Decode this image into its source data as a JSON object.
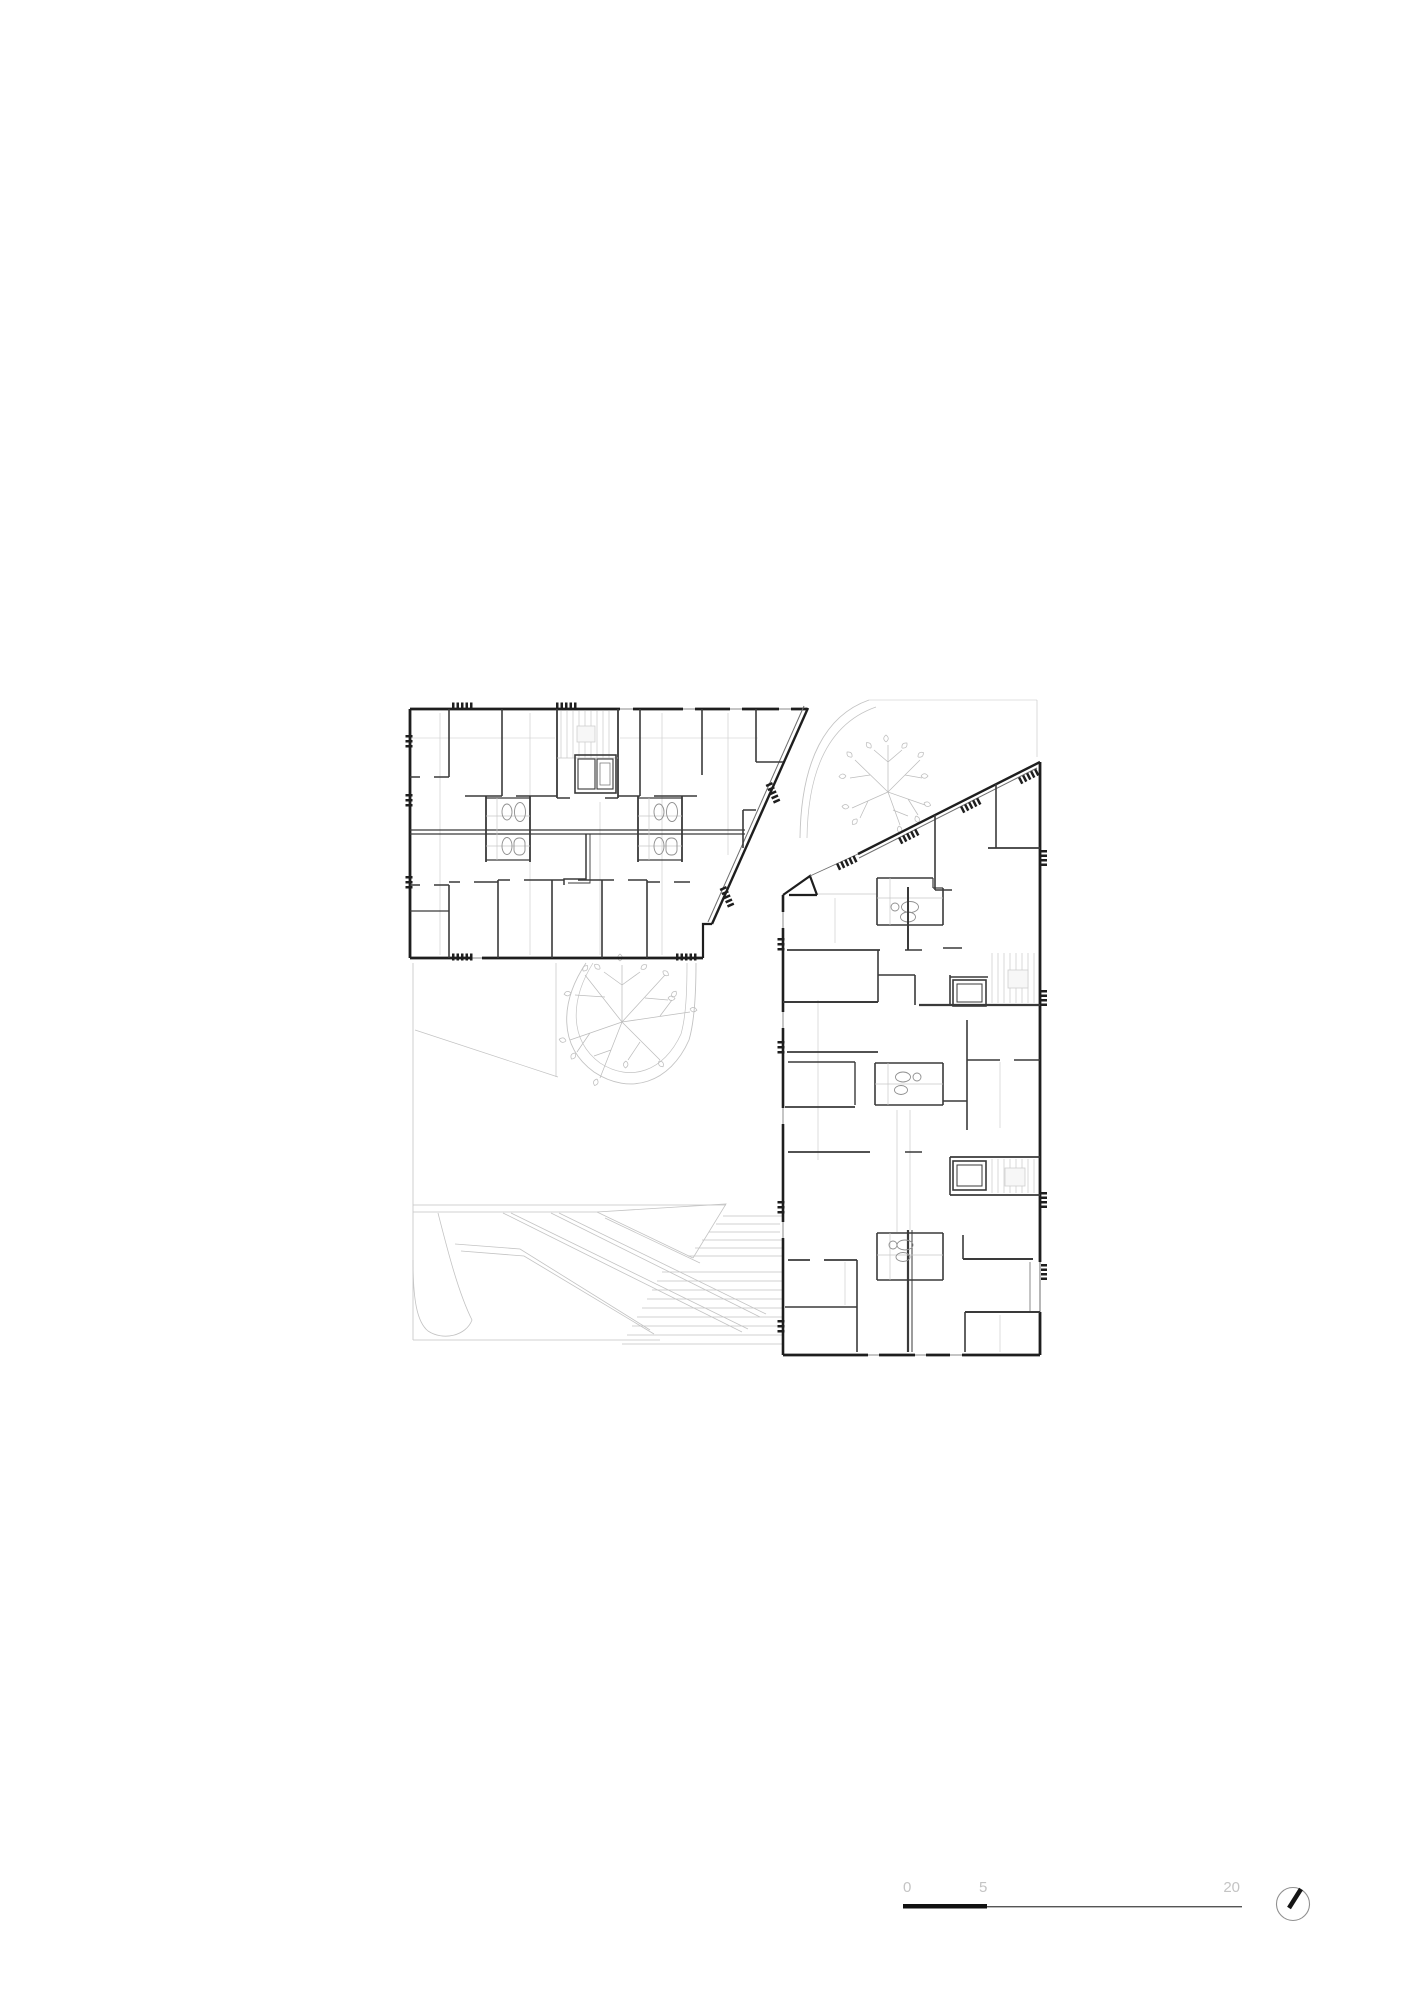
{
  "sheet": {
    "background": "#ffffff",
    "content": "architectural floor plan, two residential blocks with landscaped courtyard"
  },
  "scale_bar": {
    "label_0": "0",
    "label_5": "5",
    "label_20": "20"
  },
  "north_arrow": {
    "icon": "north-arrow-icon"
  },
  "colors": {
    "wall": "#1e1e1e",
    "partition": "#3a3a3a",
    "fine_line": "#c8c8c8",
    "site_line": "#c3c3c3",
    "tree_line": "#bdbdbd",
    "scale_text": "#c4c4c4",
    "scale_bar_thick": "#111111",
    "scale_bar_thin": "#555555",
    "north_circle": "#909090",
    "north_needle": "#151515"
  }
}
